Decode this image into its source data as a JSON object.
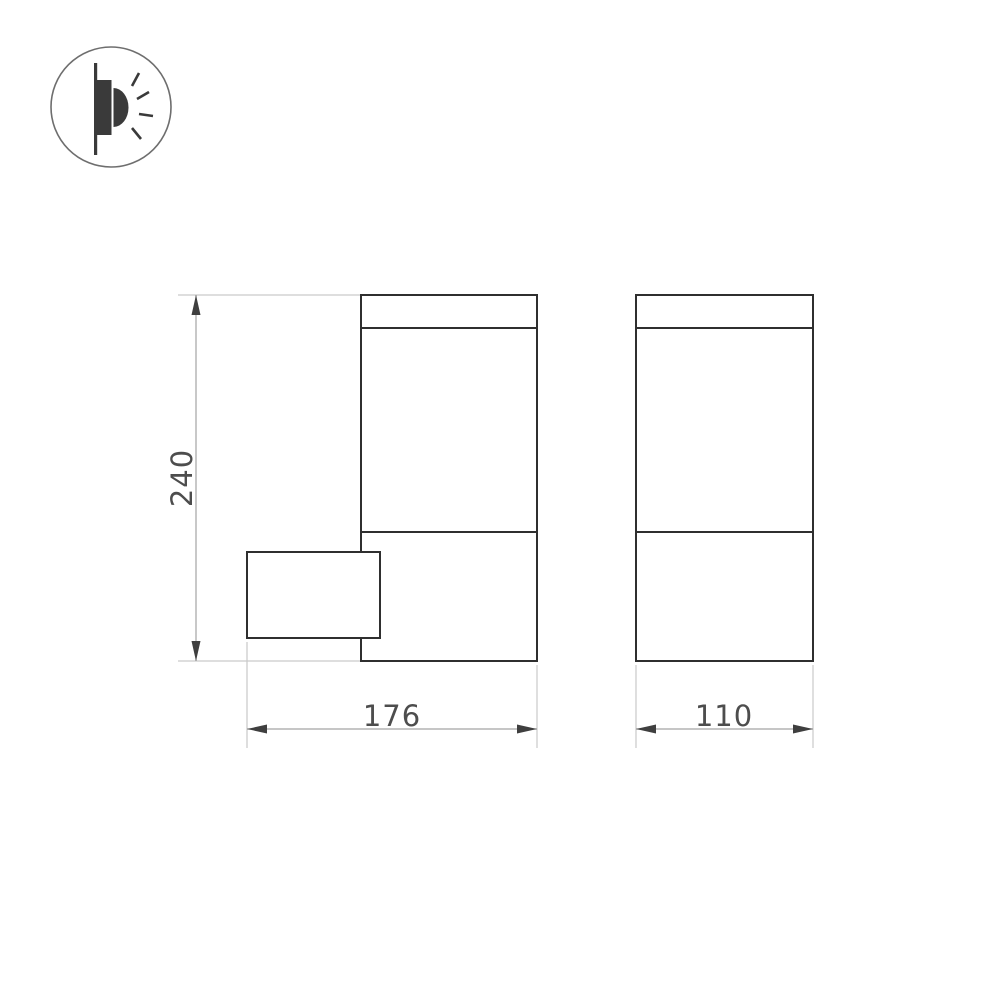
{
  "icon": {
    "name": "wall-mounted-light-side-view-icon",
    "parts": [
      "wall-line",
      "lamp-body",
      "lamp-lens",
      "light-rays"
    ]
  },
  "drawing": {
    "type": "technical-dimension-drawing",
    "views": [
      {
        "name": "front-view",
        "features": [
          "top-cap",
          "diffuser-section",
          "lower-body",
          "wall-mount-box"
        ]
      },
      {
        "name": "side-view",
        "features": [
          "top-cap",
          "diffuser-section",
          "lower-body"
        ]
      }
    ],
    "dimensions": {
      "height": "240",
      "width_front": "176",
      "depth_side": "110"
    }
  },
  "colors": {
    "background": "#ffffff",
    "outline": "#2f2f2f",
    "dimension_line": "#a3a3a3",
    "extension_line": "#c9c9c9",
    "arrow": "#3f3f3f",
    "text": "#4d4d4d",
    "icon_dark": "#3a3a3a",
    "icon_circle": "#6e6e6e"
  }
}
